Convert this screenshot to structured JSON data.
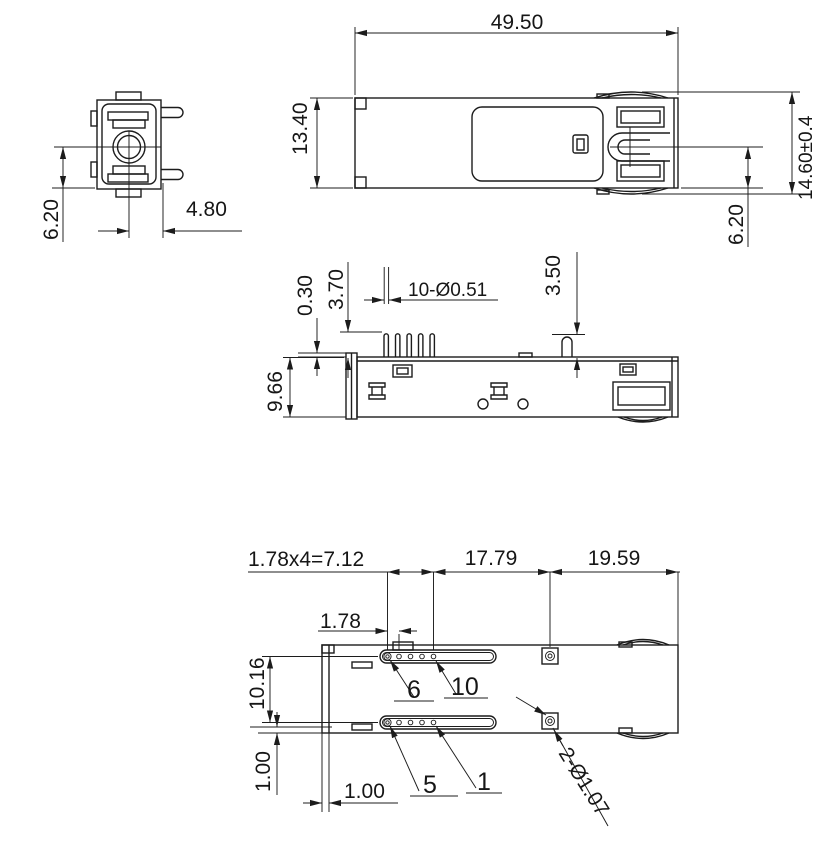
{
  "colors": {
    "line": "#1c1c1c",
    "background": "#ffffff"
  },
  "front_view": {
    "center_to_bottom": "6.20",
    "center_to_side": "4.80"
  },
  "top_view": {
    "length": "49.50",
    "width": "13.40",
    "overall_width": "14.60±0.4",
    "latch_to_edge": "6.20"
  },
  "side_view": {
    "standoff": "0.30",
    "pin_height": "3.70",
    "pin_callout": "10-Ø0.51",
    "post_height": "3.50",
    "body_height": "9.66"
  },
  "bottom_view": {
    "pin_span": "1.78x4=7.12",
    "pins_to_hole": "17.79",
    "hole_to_edge": "19.59",
    "pin_pitch": "1.78",
    "row_spacing": "10.16",
    "row_to_edge": "1.00",
    "edge_wall": "1.00",
    "pin_label_6": "6",
    "pin_label_10": "10",
    "pin_label_5": "5",
    "pin_label_1": "1",
    "hole_callout": "2-Ø1.07"
  }
}
